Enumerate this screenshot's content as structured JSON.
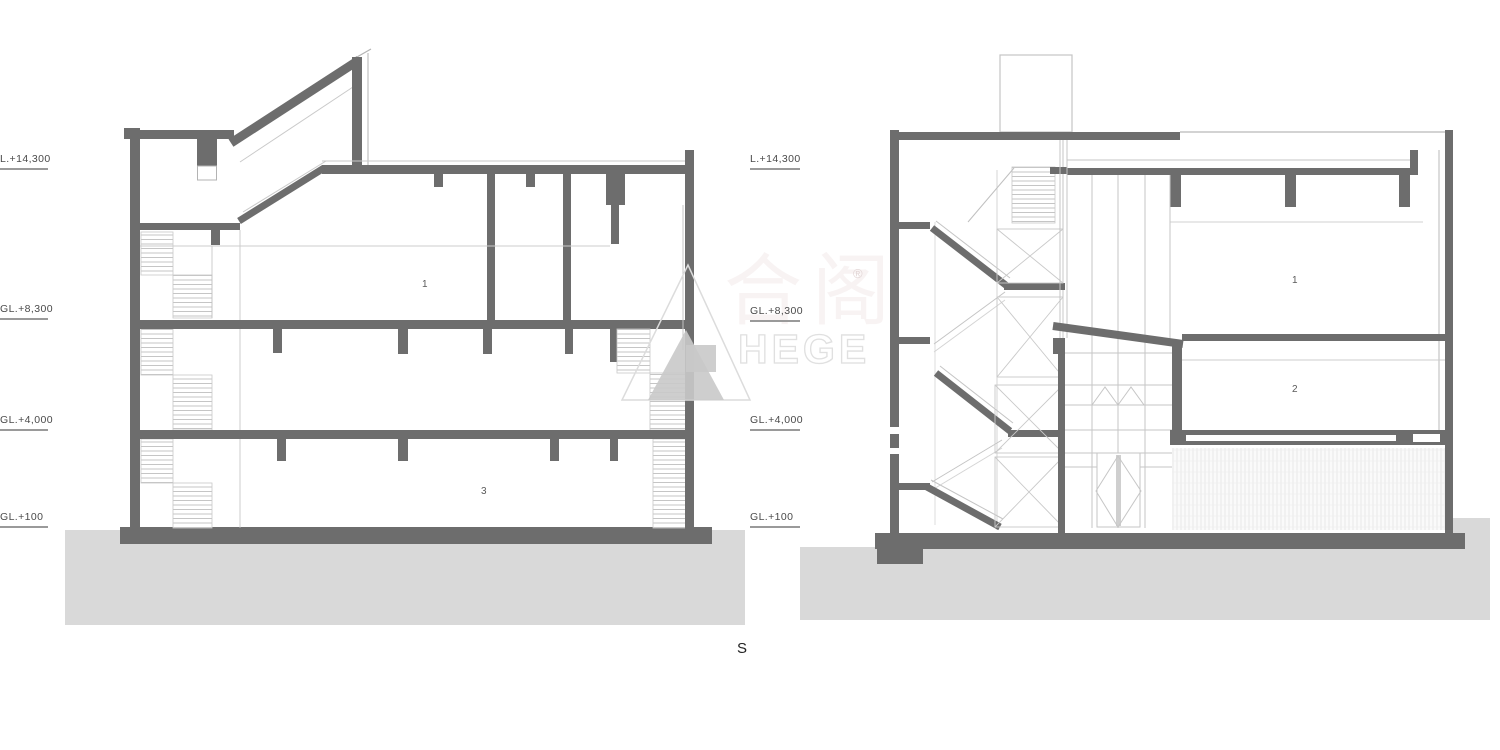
{
  "page": {
    "caption": "S"
  },
  "left_section": {
    "levels": [
      {
        "label": "L.+14,300"
      },
      {
        "label": "GL.+8,300"
      },
      {
        "label": "GL.+4,000"
      },
      {
        "label": "GL.+100"
      }
    ],
    "rooms": [
      {
        "number": "1"
      },
      {
        "number": "3"
      }
    ]
  },
  "right_section": {
    "levels": [
      {
        "label": "L.+14,300"
      },
      {
        "label": "GL.+8,300"
      },
      {
        "label": "GL.+4,000"
      },
      {
        "label": "GL.+100"
      }
    ],
    "rooms": [
      {
        "number": "1"
      },
      {
        "number": "2"
      }
    ]
  },
  "watermark": {
    "cjk": "合阁",
    "latin": "HEGE",
    "registered": "®"
  },
  "colors": {
    "wall": "#6d6d6d",
    "thin_line": "#b3b3b3",
    "tread_line": "#bfbfbf",
    "ground": "#d9d9d9",
    "label_text": "#4a4a4a",
    "underline": "#9a9a9a",
    "hatch": "#e6e6e6"
  }
}
